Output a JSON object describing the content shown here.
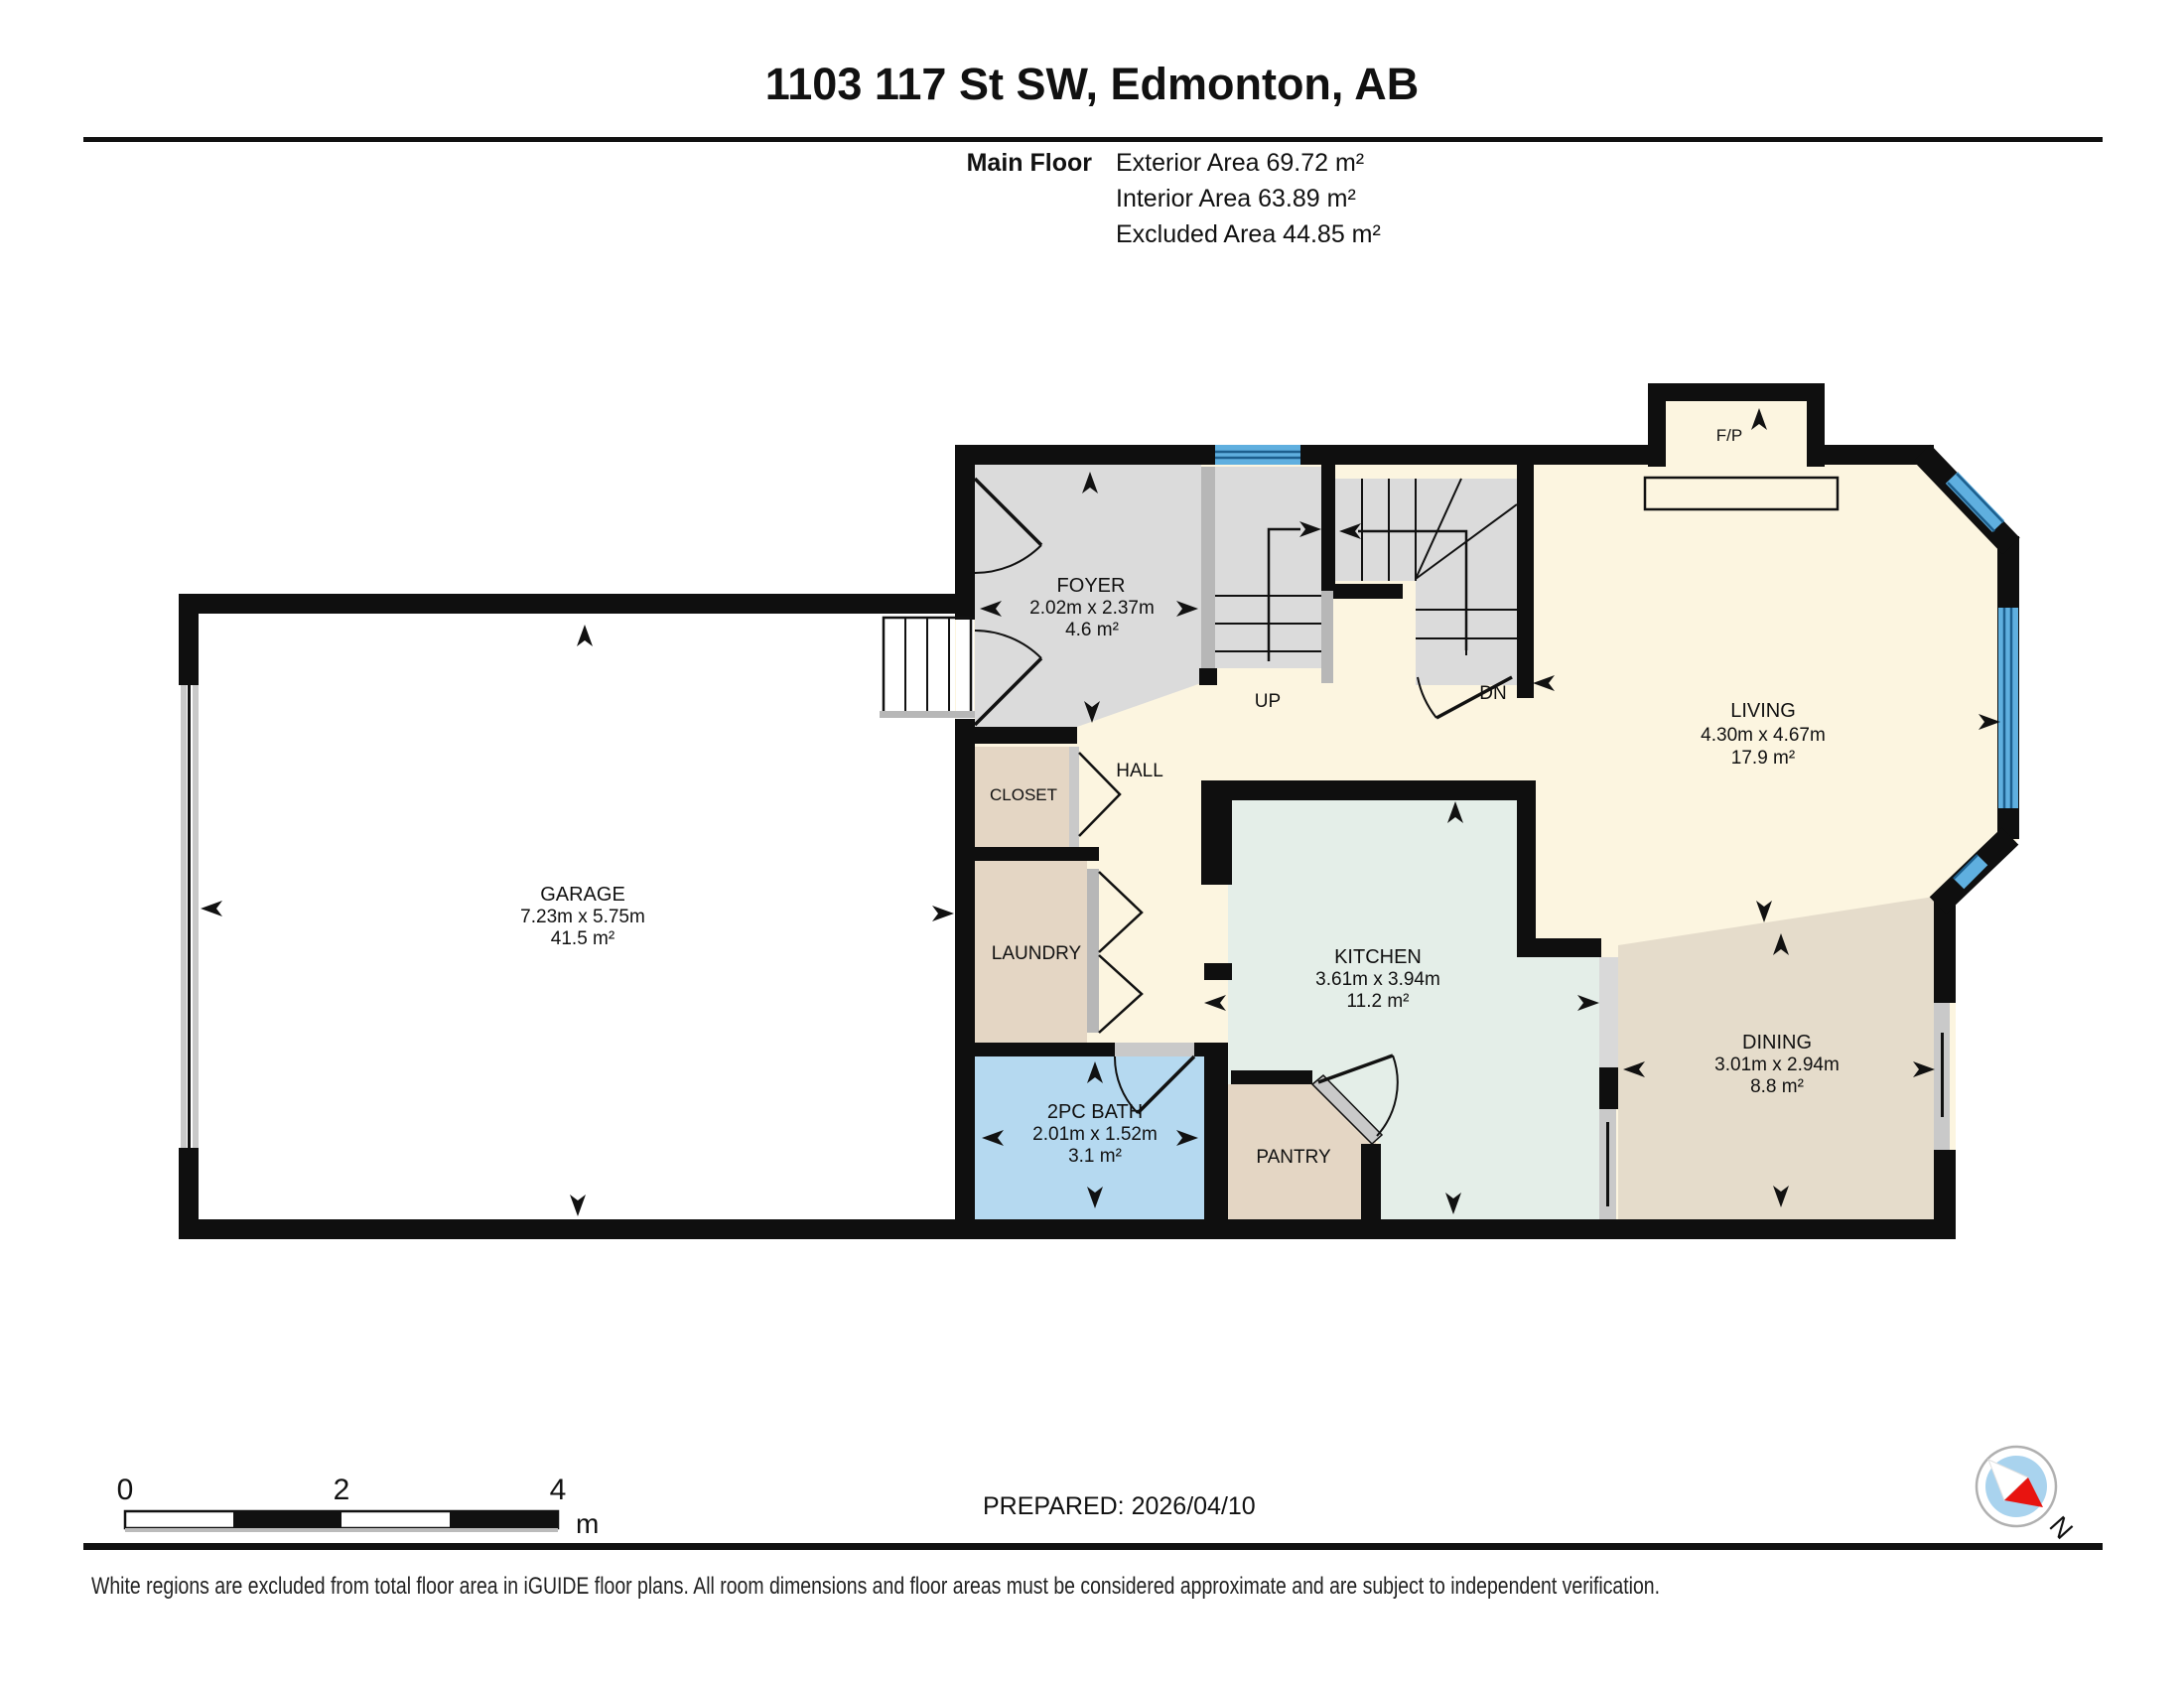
{
  "header": {
    "title": "1103 117 St SW, Edmonton, AB"
  },
  "floor_info": {
    "floor_label": "Main Floor",
    "exterior": "Exterior Area 69.72 m²",
    "interior": "Interior Area 63.89 m²",
    "excluded": "Excluded Area 44.85 m²"
  },
  "rooms": {
    "foyer": {
      "name": "FOYER",
      "dims": "2.02m x 2.37m",
      "area": "4.6 m²"
    },
    "garage": {
      "name": "GARAGE",
      "dims": "7.23m x 5.75m",
      "area": "41.5 m²"
    },
    "living": {
      "name": "LIVING",
      "dims": "4.30m x 4.67m",
      "area": "17.9 m²"
    },
    "kitchen": {
      "name": "KITCHEN",
      "dims": "3.61m x 3.94m",
      "area": "11.2 m²"
    },
    "dining": {
      "name": "DINING",
      "dims": "3.01m x 2.94m",
      "area": "8.8 m²"
    },
    "bath": {
      "name": "2PC BATH",
      "dims": "2.01m x 1.52m",
      "area": "3.1 m²"
    },
    "hall": {
      "name": "HALL"
    },
    "closet": {
      "name": "CLOSET"
    },
    "laundry": {
      "name": "LAUNDRY"
    },
    "pantry": {
      "name": "PANTRY"
    }
  },
  "stairs": {
    "up": "UP",
    "down": "DN"
  },
  "fireplace": {
    "label": "F/P"
  },
  "scale_bar": {
    "tick0": "0",
    "tick1": "2",
    "tick2": "4",
    "unit": "m"
  },
  "prepared": "PREPARED: 2026/04/10",
  "compass": {
    "north": "N"
  },
  "footer": "White regions are excluded from total floor area in iGUIDE floor plans. All room dimensions and floor areas must be considered approximate and are subject to independent verification.",
  "colors": {
    "wall": "#0f0f0f",
    "interior_cream": "#fcf5e0",
    "foyer_gray": "#dbdbdb",
    "kitchen_mint": "#e4eee8",
    "closet_tan": "#e4d6c4",
    "dining_tan": "#e5dccb",
    "bath_blue": "#b5d9f0",
    "window_blue": "#5fafdf",
    "compass_fill": "#a9d3ee",
    "compass_needle_red": "#e81410"
  }
}
